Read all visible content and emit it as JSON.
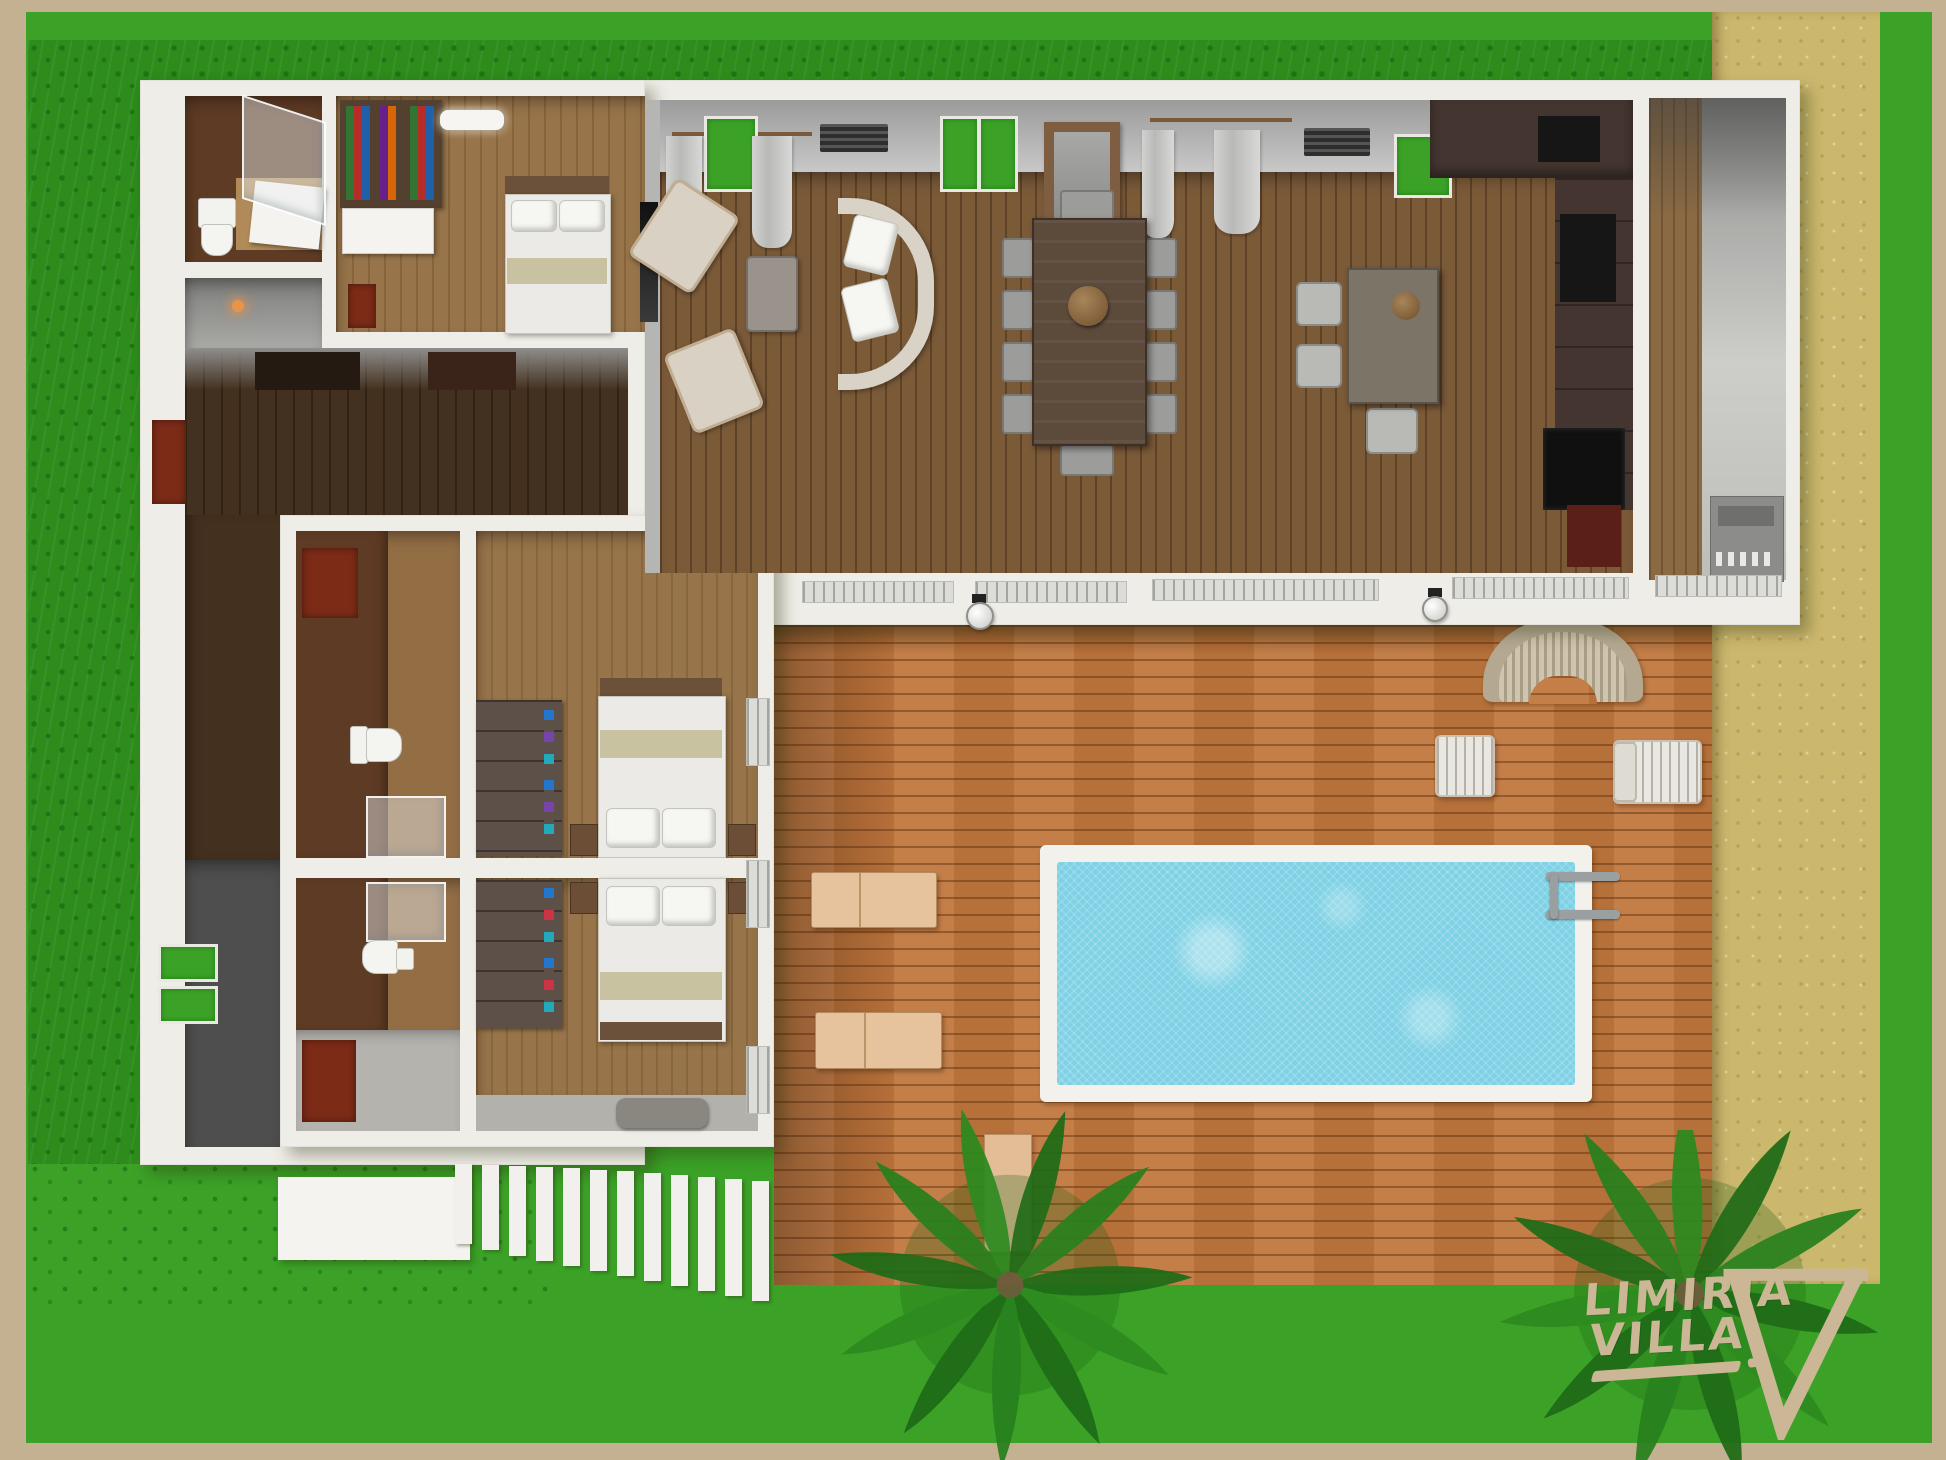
{
  "logo": {
    "line1": "LIMIRIA",
    "line2": "VILLA",
    "mark": "v-triangle-brush"
  },
  "colors": {
    "border": "#c4b191",
    "grass": "#3ba227",
    "hedge": "#2e8c1c",
    "hedge_dot": "#1f7414",
    "sand": "#ccb86d",
    "sand_dot": "#b7a258",
    "wall": "#efede7",
    "deck": "#c0773e",
    "pool": "#7fd2e5",
    "pool_rim": "#f2f1ec",
    "lounger": "#e6c29d",
    "logo": "#cbb795",
    "accent_red": "#7c2b17",
    "floor_living": "#7b5a38",
    "floor_hall": "#44301e",
    "floor_bath": "#5e3b24",
    "floor_bedroom": "#97744a",
    "wardrobe": "#5c5048",
    "bed_khaki": "#c9c2a0",
    "kitchen_dark": "#443530",
    "appliance_black": "#161616",
    "dark_room": "#4e4e4e",
    "palm": "#1e6b16",
    "palm_light": "#2c8a1f"
  },
  "scene": {
    "type": "3d-floor-plan-top-view",
    "rooms": [
      "bathroom-ensuite-north",
      "entry-hall-nook",
      "guest-bedroom",
      "living-room",
      "dining-area",
      "kitchen",
      "utility-corridor",
      "hallway",
      "dark-storage-room",
      "bathroom-ensuite-1",
      "bathroom-ensuite-2",
      "bedroom-double-1",
      "bedroom-double-2",
      "store-room",
      "porch-nook"
    ],
    "furniture": [
      "single-bed",
      "double-bed-1",
      "double-bed-2",
      "wardrobe-1",
      "wardrobe-2",
      "bookshelf",
      "dresser",
      "red-painting",
      "toilet-1",
      "toilet-2",
      "toilet-3",
      "shower-1",
      "shower-2",
      "shower-3",
      "vanity",
      "curved-sofa",
      "armchair-1",
      "armchair-2",
      "coffee-table",
      "dining-table",
      "dining-chairs",
      "bar-table",
      "bar-stools",
      "kitchen-cabinets",
      "oven-black",
      "laundry-appliances",
      "ceiling-light",
      "wall-lamps",
      "storage-bench"
    ],
    "outdoor": [
      "wood-deck",
      "swimming-pool",
      "pool-ladder",
      "sun-lounger-1",
      "sun-lounger-2",
      "towel-mat",
      "wicker-bench",
      "side-table",
      "deck-armchair",
      "white-patio",
      "louver-steps",
      "palm-tree-1",
      "palm-tree-2",
      "sand-path",
      "lawn",
      "hedge-strip"
    ]
  }
}
